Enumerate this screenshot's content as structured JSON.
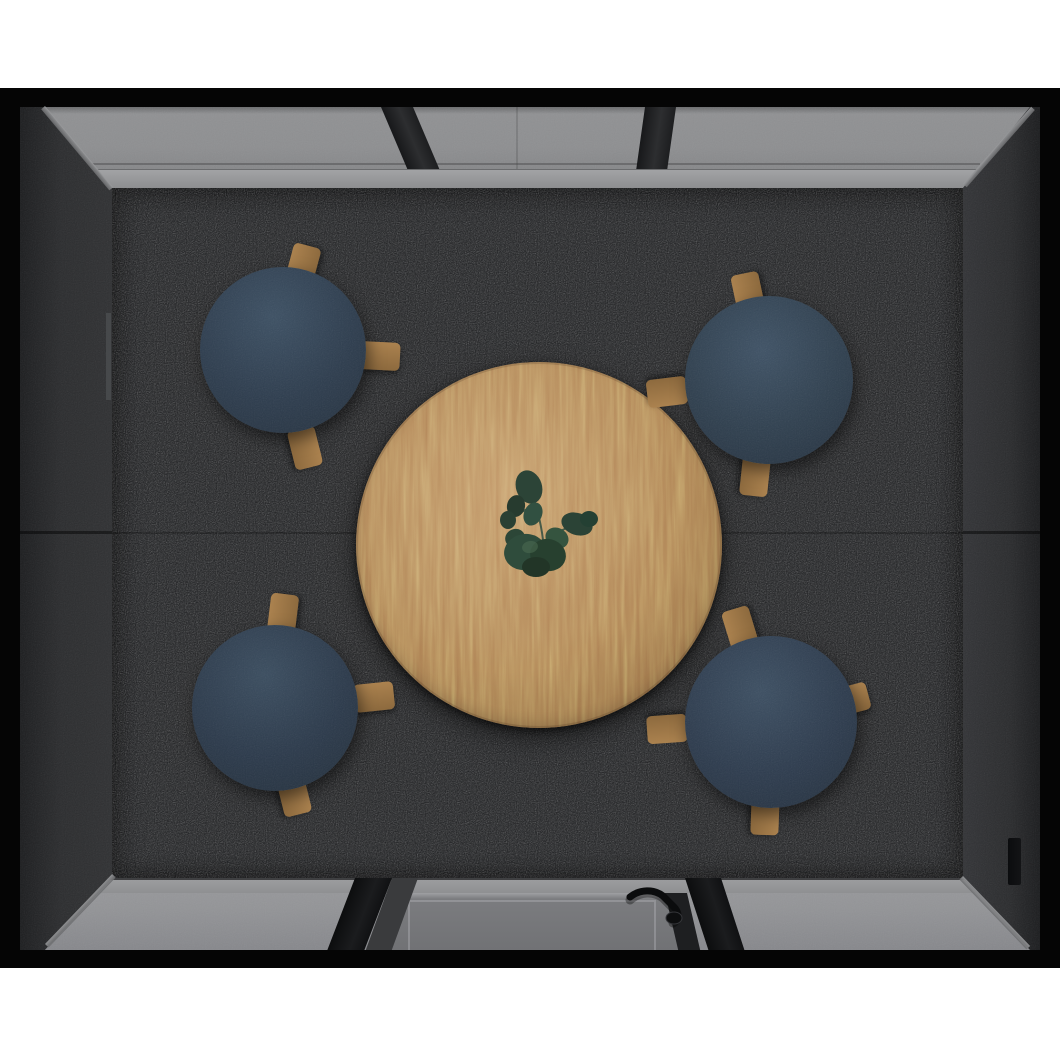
{
  "scene": {
    "description": "Top-down 3D render of a square acoustic meeting pod with a round oak table, eucalyptus centerpiece, four navy round stools on dark speckled carpet, glass rear wall, glass front wall with door, and dark felt side walls inside a black frame on a white background",
    "view": "top-down",
    "background_color": "#ffffff",
    "frame_color": "#050505",
    "walls": {
      "left": {
        "label": "Left felt wall panel",
        "color": "#2c2d2f",
        "details": [
          "horizontal seam",
          "hinge strip"
        ]
      },
      "right": {
        "label": "Right felt wall panel",
        "color": "#2c2d2f",
        "details": [
          "horizontal seam",
          "recessed slot near front corner"
        ]
      },
      "top": {
        "label": "Rear glass wall",
        "glass_color": "#8d8e90",
        "mullion_count": 2,
        "mullion_color": "#222326",
        "sill_color": "#9a9b9d"
      },
      "bottom": {
        "label": "Front glass wall with door",
        "glass_color": "#929396",
        "door_glass_color": "#75767a",
        "post_count": 2,
        "handle": {
          "label": "Black door lever handle",
          "color": "#0b0c0d",
          "position": "right side of door"
        }
      }
    },
    "floor": {
      "label": "Charcoal speckled carpet",
      "color": "#1d1e20",
      "speckle_colors": [
        "#4a4b4d",
        "#6a6b6d"
      ]
    },
    "furniture": {
      "table": {
        "label": "Round oak table",
        "shape": "circle",
        "color": "#b3885a",
        "center_x": 539,
        "center_y": 545,
        "radius": 183
      },
      "plant": {
        "label": "Eucalyptus sprig centerpiece",
        "color": "#2d4737"
      },
      "stools": [
        {
          "label": "Navy stool top left",
          "color": "#2e3d4e",
          "center_x": 283,
          "center_y": 350,
          "radius": 83,
          "visible_legs": 3
        },
        {
          "label": "Navy stool top right",
          "color": "#30404f",
          "center_x": 769,
          "center_y": 380,
          "radius": 84,
          "visible_legs": 3
        },
        {
          "label": "Navy stool bottom left",
          "color": "#2c3a4b",
          "center_x": 275,
          "center_y": 708,
          "radius": 83,
          "visible_legs": 3
        },
        {
          "label": "Navy stool bottom right",
          "color": "#2e3c4e",
          "center_x": 771,
          "center_y": 722,
          "radius": 86,
          "visible_legs": 4
        }
      ],
      "stool_leg_color": "#a07a49"
    }
  }
}
